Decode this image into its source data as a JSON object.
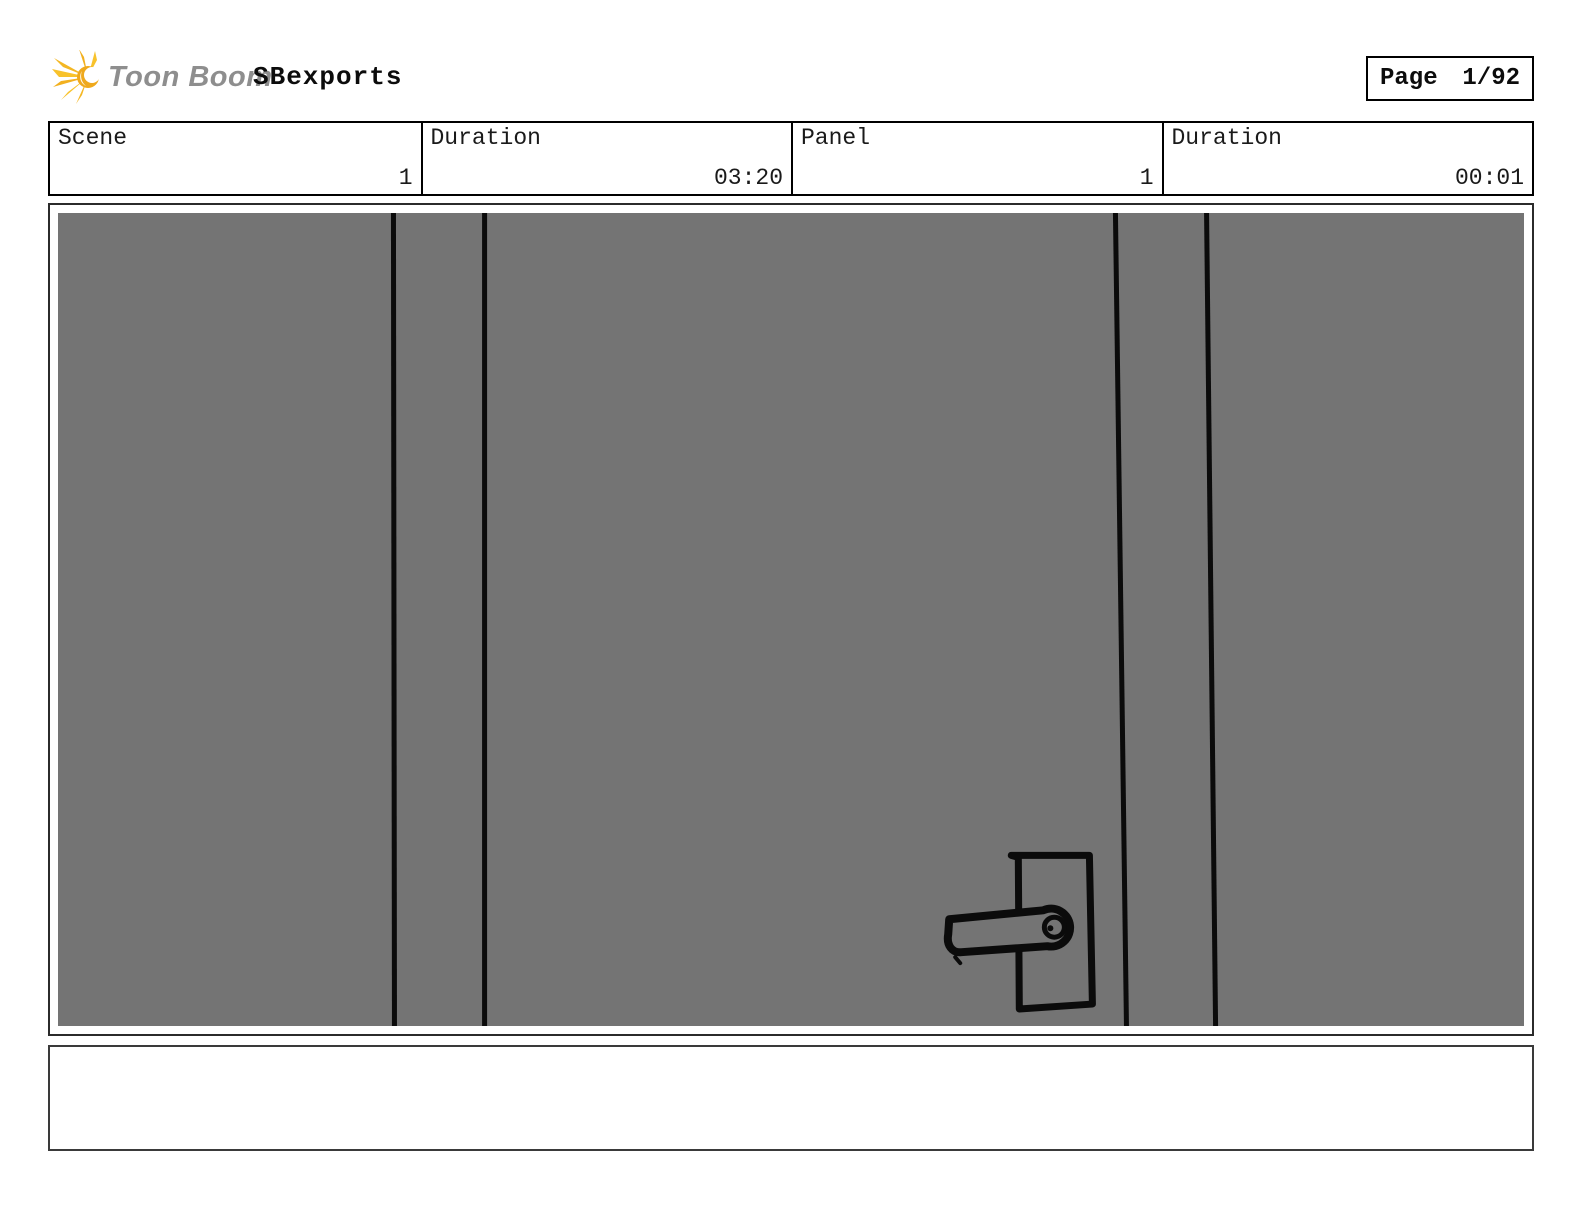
{
  "header": {
    "brand": "Toon Boom",
    "title": "SBexports",
    "page": {
      "label": "Page",
      "value": "1/92"
    },
    "logo_colors": {
      "ray_yellow": "#F8C22B",
      "ray_deep": "#EFA91C",
      "text_gray": "#8E8E8E"
    }
  },
  "info_table": {
    "cells": [
      {
        "label": "Scene",
        "value": "1"
      },
      {
        "label": "Duration",
        "value": "03:20"
      },
      {
        "label": "Panel",
        "value": "1"
      },
      {
        "label": "Duration",
        "value": "00:01"
      }
    ]
  },
  "panel": {
    "description": "Storyboard drawing: close-up of a gray door with frame lines and a lever door handle on a rectangular plate",
    "canvas_color": "#747474",
    "stroke_color": "#0b0b0b"
  },
  "caption": {
    "text": ""
  }
}
